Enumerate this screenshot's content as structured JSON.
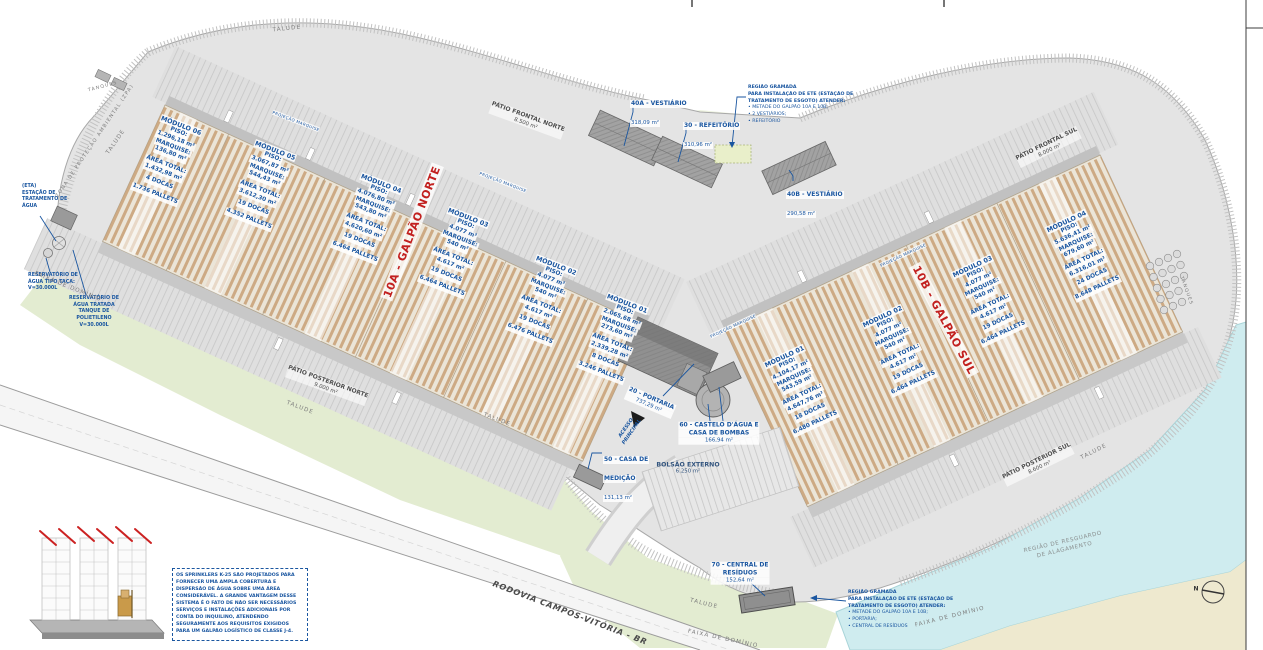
{
  "warehouse_north": {
    "id": "10A - GALPÃO NORTE",
    "modules": [
      {
        "name": "MÓDULO 06",
        "piso": "1.296,18 m²",
        "marquise": "136,80 m²",
        "area": "1.432,98 m²",
        "docas": "4 DOCAS",
        "pallets": "1.736 PALLETS"
      },
      {
        "name": "MÓDULO 05",
        "piso": "3.067,87 m²",
        "marquise": "544,43 m²",
        "area": "3.612,30 m²",
        "docas": "19 DOCAS",
        "pallets": "4.352 PALLETS"
      },
      {
        "name": "MÓDULO 04",
        "piso": "4.076,80 m²",
        "marquise": "543,80 m²",
        "area": "4.620,60 m²",
        "docas": "19 DOCAS",
        "pallets": "6.464 PALLETS"
      },
      {
        "name": "MÓDULO 03",
        "piso": "4.077 m²",
        "marquise": "540 m²",
        "area": "4.617 m²",
        "docas": "19 DOCAS",
        "pallets": "6.464 PALLETS"
      },
      {
        "name": "MÓDULO 02",
        "piso": "4.077 m²",
        "marquise": "540 m²",
        "area": "4.617 m²",
        "docas": "19 DOCAS",
        "pallets": "6.476 PALLETS"
      },
      {
        "name": "MÓDULO 01",
        "piso": "2.065,68 m²",
        "marquise": "273,60 m²",
        "area": "2.339,28 m²",
        "docas": "8 DOCAS",
        "pallets": "3.246 PALLETS"
      }
    ]
  },
  "warehouse_south": {
    "id": "10B - GALPÃO SUL",
    "modules": [
      {
        "name": "MÓDULO 01",
        "piso": "4.104,17 m²",
        "marquise": "543,59 m²",
        "area": "4.647,76 m²",
        "docas": "18 DOCAS",
        "pallets": "6.480 PALLETS"
      },
      {
        "name": "MÓDULO 02",
        "piso": "4.077 m²",
        "marquise": "540 m²",
        "area": "4.617 m²",
        "docas": "19 DOCAS",
        "pallets": "6.464 PALLETS"
      },
      {
        "name": "MÓDULO 03",
        "piso": "4.077 m²",
        "marquise": "540 m²",
        "area": "4.617 m²",
        "docas": "19 DOCAS",
        "pallets": "6.464 PALLETS"
      },
      {
        "name": "MÓDULO 04",
        "piso": "5.636,41 m²",
        "marquise": "679,60 m²",
        "area": "6.316,01 m²",
        "docas": "24 DOCAS",
        "pallets": "8.648 PALLETS"
      }
    ]
  },
  "module_labels": {
    "piso": "PISO:",
    "marquise": "MARQUISE:",
    "area": "ÁREA TOTAL:"
  },
  "patios": {
    "frontal_norte": {
      "name": "PÁTIO FRONTAL NORTE",
      "area": "8.500 m²"
    },
    "frontal_sul": {
      "name": "PÁTIO FRONTAL SUL",
      "area": "8.000 m²"
    },
    "posterior_norte": {
      "name": "PÁTIO POSTERIOR NORTE",
      "area": "9.000 m²"
    },
    "posterior_sul": {
      "name": "PÁTIO POSTERIOR SUL",
      "area": "8.600 m²"
    }
  },
  "facilities": {
    "vestiario_40a": {
      "name": "40A - VESTIÁRIO",
      "area": "318,09 m²"
    },
    "refeitorio_30": {
      "name": "30 - REFEITÓRIO",
      "area": "310,96 m²"
    },
    "vestiario_40b": {
      "name": "40B - VESTIÁRIO",
      "area": "290,58 m²"
    },
    "portaria_20": {
      "name": "20 - PORTARIA",
      "area": "737,29 m²"
    },
    "castelo_60": {
      "line1": "60 - CASTELO D'ÁGUA E",
      "line2": "CASA DE BOMBAS",
      "area": "166,94 m²"
    },
    "medicao_50": {
      "line1": "50 - CASA DE",
      "line2": "MEDIÇÃO",
      "area": "131,13 m²"
    },
    "residuos_70": {
      "line1": "70 - CENTRAL DE",
      "line2": "RESÍDUOS",
      "area": "152,64 m²"
    },
    "bolsao": {
      "name": "BOLSÃO EXTERNO",
      "area": "6.250 m²"
    },
    "eta": {
      "l1": "(ETA)",
      "l2": "ESTAÇÃO DE",
      "l3": "TRATAMENTO DE",
      "l4": "ÁGUA"
    },
    "reservatorio_taca": {
      "l1": "RESERVATÓRIO DE",
      "l2": "ÁGUA TIPO TAÇA:",
      "l3": "V=30.000L"
    },
    "reservatorio_tratada": {
      "l1": "RESERVATÓRIO DE",
      "l2": "ÁGUA TRATADA",
      "l3": "TANQUE DE",
      "l4": "POLIETILENO",
      "l5": "V=30.000L"
    }
  },
  "notes": {
    "ete_norte": {
      "l1": "REGIÃO GRAMADA",
      "l2": "PARA INSTALAÇÃO DE ETE (ESTAÇÃO DE",
      "l3": "TRATAMENTO DE ESGOTO) ATENDER:",
      "l4": "• METADE DO GALPÃO 10A E 10B;",
      "l5": "• 2 VESTIÁRIOS;",
      "l6": "• REFEITÓRIO"
    },
    "ete_sul": {
      "l1": "REGIÃO GRAMADA",
      "l2": "PARA INSTALAÇÃO DE ETE (ESTAÇÃO DE",
      "l3": "TRATAMENTO DE ESGOTO) ATENDER:",
      "l4": "• METADE DO GALPÃO 10A E 10B;",
      "l5": "• PORTARIA;",
      "l6": "• CENTRAL DE RESÍDUOS"
    },
    "sprinkler": {
      "l1": "OS SPRINKLERS K-25 SÃO PROJETADOS PARA",
      "l2": "FORNECER UMA AMPLA COBERTURA E",
      "l3": "DISPERSÃO DE ÁGUA SOBRE UMA ÁREA",
      "l4": "CONSIDERÁVEL. A GRANDE VANTAGEM DESSE",
      "l5": "SISTEMA É O FATO DE NÃO SER NECESSÁRIOS",
      "l6": "SERVIÇOS E INSTALAÇÕES ADICIONAIS POR",
      "l7": "CONTA DO INQUILINO, ATENDENDO",
      "l8": "SEGURAMENTE AOS REQUISITOS EXIGIDOS",
      "l9": "PARA UM GALPÃO LOGÍSTICO DE CLASSE J-4."
    }
  },
  "terrain_labels": {
    "talude": "TALUDE",
    "faixa_dominio": "FAIXA DE DOMÍNIO",
    "rodovia": "RODOVIA CAMPOS-VITÓRIA - BR",
    "zona_protecao": "ZONA DE PROTEÇÃO AMBIENTAL (ZPA)",
    "tanques": "TANQUES",
    "projecao_marquise": "PROJEÇÃO MARQUISE",
    "acesso_l1": "ACESSO",
    "acesso_l2": "PRINCIPAL",
    "resguardo_l1": "REGIÃO DE RESGUARDO",
    "resguardo_l2": "DE ALAGAMENTO",
    "north": "N"
  },
  "colors": {
    "annotation_blue": "#1a56a0",
    "warehouse_red": "#c2201f",
    "water": "#cfecef",
    "grass": "#e3ecd1",
    "rack_tan": "#c8a076"
  }
}
